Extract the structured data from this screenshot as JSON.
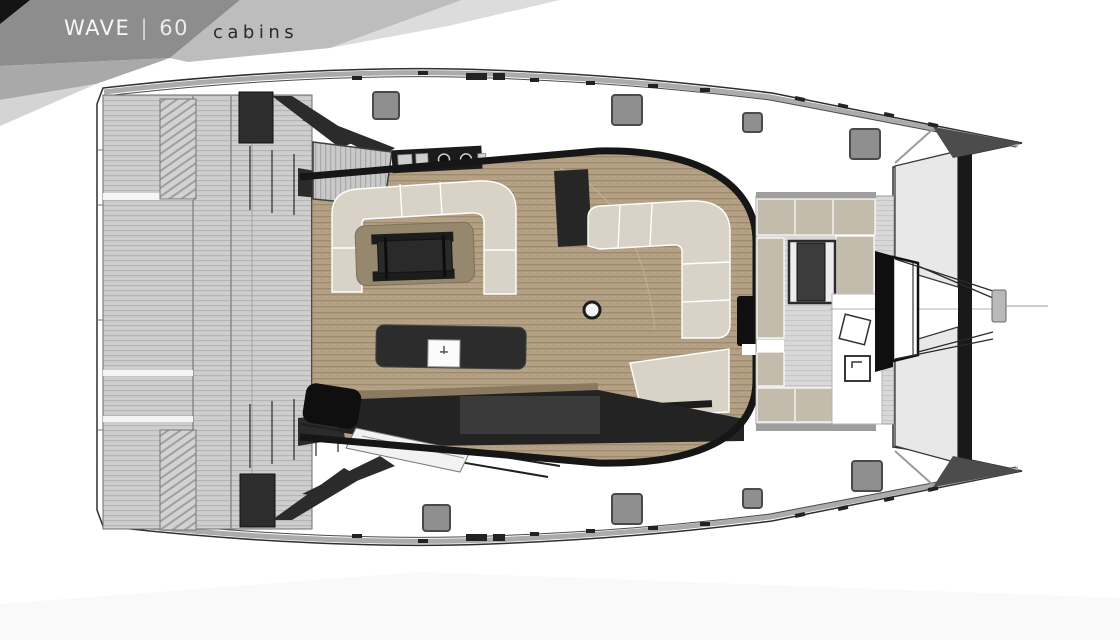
{
  "header": {
    "brand": "WAVE",
    "separator": "|",
    "model": "60",
    "page_label": "cabins"
  },
  "palette": {
    "banner_dark": "#141414",
    "banner_gray": "#8d8d8d",
    "banner_light": "#bdbdbd",
    "banner_lighter": "#dcdcdc",
    "hull_outline": "#2e2e2e",
    "gunwale_gray": "#ababab",
    "sofa_cream": "#d8d3c6",
    "cushion_beige": "#c3bbab",
    "rug_brown": "#96886f",
    "furniture_dark": "#232323",
    "island_dark": "#2c2c2c",
    "hatch_gray": "#8f8f8f",
    "trampoline_gray": "#e8e8e8",
    "bow_wedge_dark": "#4c4c4c",
    "windshield_black": "#161616"
  }
}
